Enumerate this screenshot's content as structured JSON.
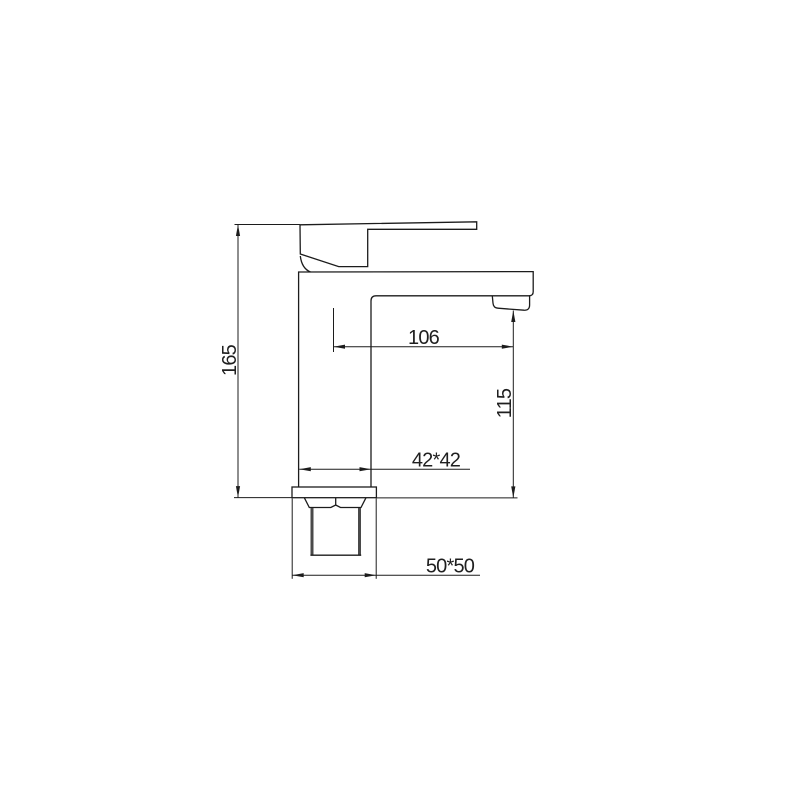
{
  "page": {
    "background_color": "#ffffff"
  },
  "drawing": {
    "kind": "technical-dimension-drawing",
    "subject": "single-lever basin faucet, side view",
    "line_color": "#1c1c1c",
    "text_color": "#1f1f1f",
    "thread_shading_color": "#4a4a4a",
    "dimensions": {
      "overall_height": "165",
      "spout_reach": "106",
      "outlet_height": "115",
      "body_section": "42*42",
      "base_section": "50*50"
    }
  }
}
